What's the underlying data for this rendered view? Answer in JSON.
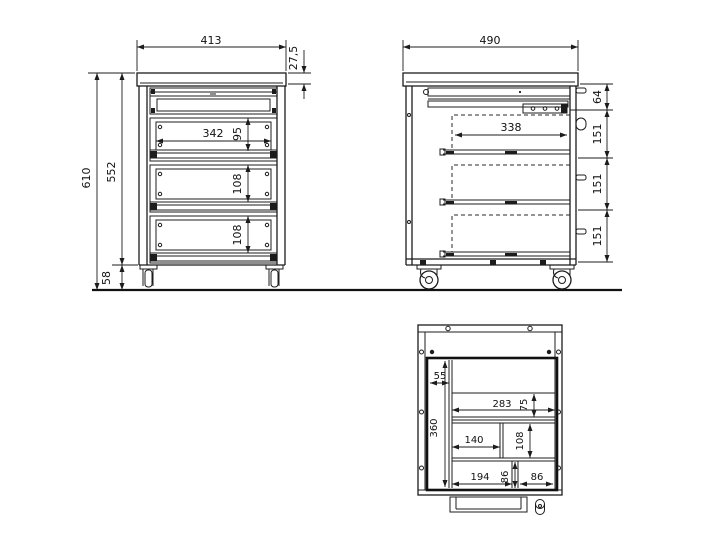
{
  "views": {
    "front": {
      "width": "413",
      "worktop_detail": "27,5",
      "total_height": "610",
      "body_height": "552",
      "caster_height": "58",
      "drawer_opening_width": "342",
      "pencil_drawer_front_height": "95",
      "drawer_front_height_mid": "108",
      "drawer_front_height_bottom": "108"
    },
    "side": {
      "depth": "490",
      "top_section_height": "64",
      "drawer_depth": "338",
      "section_height_1": "151",
      "section_height_2": "151",
      "section_height_3": "151"
    },
    "top": {
      "pen_slot_width": "55",
      "tray_inner_depth": "360",
      "back_compartment_width": "283",
      "back_compartment_depth": "75",
      "middle_compartment_width": "140",
      "middle_compartment_depth": "108",
      "front_compartment_width": "194",
      "front_compartment_depth": "86",
      "front_right_compartment_width": "86"
    }
  },
  "colors": {
    "line": "#1c1c1c",
    "background": "#ffffff"
  }
}
